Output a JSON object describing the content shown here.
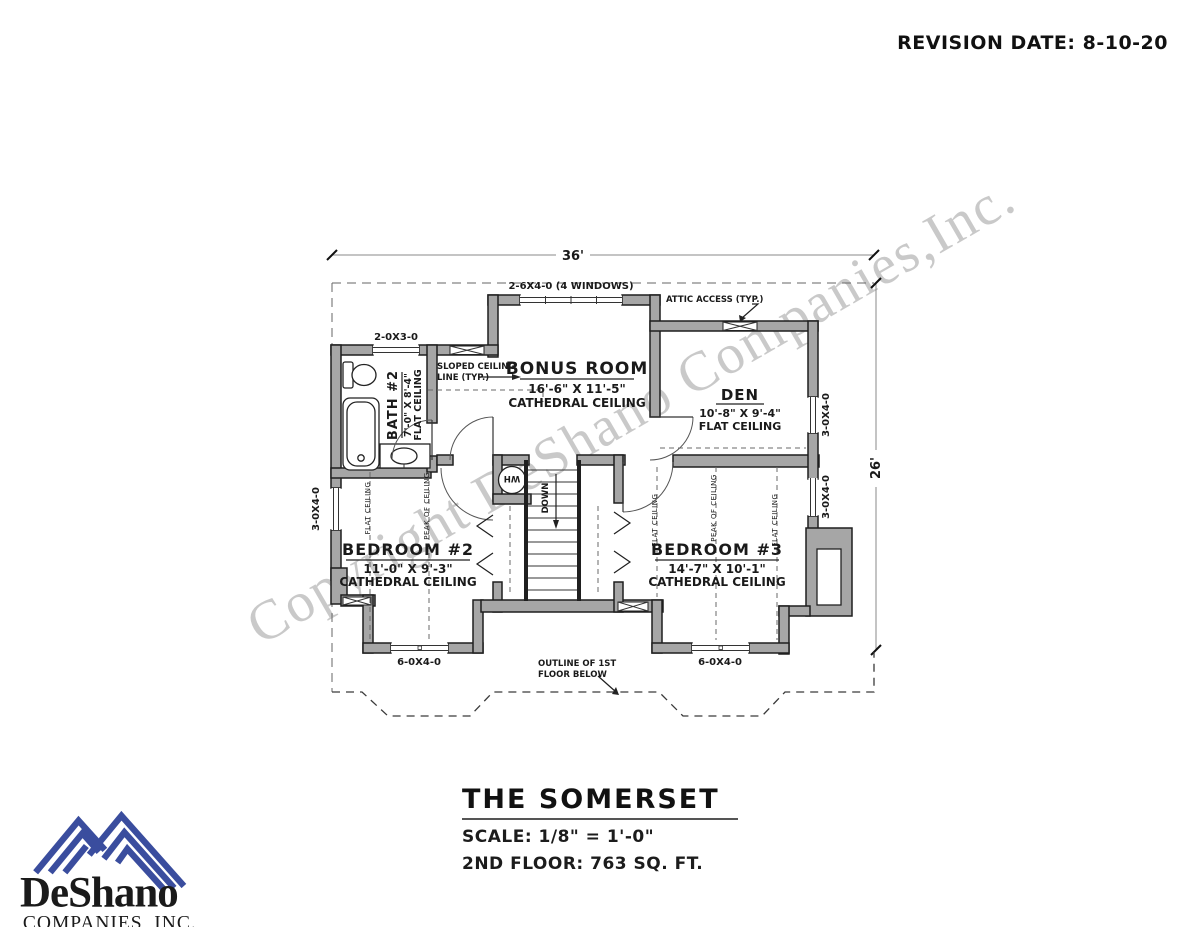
{
  "revision": {
    "label": "REVISION DATE: 8-10-20"
  },
  "watermark": {
    "text": "Copyright DeShano Companies,Inc."
  },
  "title_block": {
    "name": "THE SOMERSET",
    "scale": "SCALE: 1/8\" = 1'-0\"",
    "floor_info": "2ND FLOOR: 763 SQ. FT."
  },
  "logo": {
    "name": "DeShano",
    "subtitle": "COMPANIES, INC."
  },
  "plan": {
    "dims": {
      "width": "36'",
      "depth": "26'"
    },
    "rooms": {
      "bonus": {
        "name": "BONUS ROOM",
        "size": "16'-6\" X 11'-5\"",
        "ceiling": "CATHEDRAL CEILING"
      },
      "den": {
        "name": "DEN",
        "size": "10'-8\" X 9'-4\"",
        "ceiling": "FLAT CEILING"
      },
      "bath": {
        "name": "BATH #2",
        "size": "7'-0\" X 8'-4\"",
        "ceiling": "FLAT CEILING"
      },
      "bedroom2": {
        "name": "BEDROOM #2",
        "size": "11'-0\" X 9'-3\"",
        "ceiling": "CATHEDRAL CEILING"
      },
      "bedroom3": {
        "name": "BEDROOM #3",
        "size": "14'-7\" X 10'-1\"",
        "ceiling": "CATHEDRAL CEILING"
      }
    },
    "windows": {
      "bonus_top": "2-6X4-0 (4 WINDOWS)",
      "bath_top": "2-0X3-0",
      "left": "3-0X4-0",
      "den_right": "3-0X4-0",
      "bedroom3_right": "3-0X4-0",
      "bedroom2_bottom": "6-0X4-0",
      "bedroom3_bottom": "6-0X4-0"
    },
    "annotations": {
      "attic": "ATTIC ACCESS (TYP.)",
      "sloped_1": "SLOPED CEILING",
      "sloped_2": "LINE (TYP.)",
      "outline_1": "OUTLINE OF 1ST",
      "outline_2": "FLOOR BELOW",
      "down": "DOWN",
      "wh": "WH",
      "flat_ceiling": "FLAT CEILING",
      "peak_of_ceiling": "PEAK OF CEILING"
    }
  }
}
